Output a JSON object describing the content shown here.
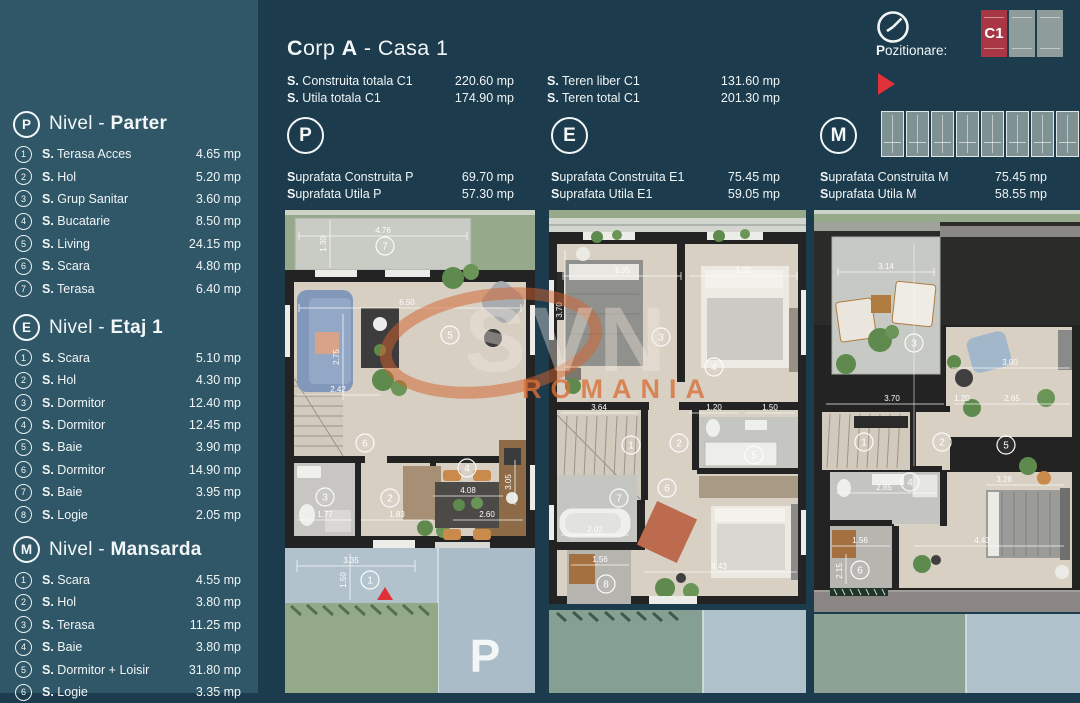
{
  "header": {
    "title_segments": [
      {
        "t": "C",
        "b": 1
      },
      {
        "t": "orp ",
        "b": 0
      },
      {
        "t": "A",
        "b": 1
      },
      {
        "t": " - Casa 1",
        "b": 0
      }
    ],
    "totals_col1": [
      {
        "label": "S. Construita totala C1",
        "value": "220.60 mp"
      },
      {
        "label": "S. Utila totala C1",
        "value": "174.90 mp"
      }
    ],
    "totals_col2": [
      {
        "label": "S. Teren liber C1",
        "value": "131.60 mp"
      },
      {
        "label": "S. Teren total C1",
        "value": "201.30 mp"
      }
    ]
  },
  "pozitionare": {
    "label": "Pozitionare:",
    "unit_tiles": [
      {
        "tag": "C1",
        "variant": "red"
      },
      {
        "tag": "",
        "variant": "grey"
      },
      {
        "tag": "",
        "variant": "grey"
      }
    ],
    "site_tiles": 8
  },
  "sidebar": {
    "sections": [
      {
        "letter": "P",
        "title_prefix": "Nivel - ",
        "title_bold": "Parter",
        "items": [
          {
            "num": "1",
            "label": "S. Terasa Acces",
            "value": "4.65 mp"
          },
          {
            "num": "2",
            "label": "S. Hol",
            "value": "5.20 mp"
          },
          {
            "num": "3",
            "label": "S. Grup Sanitar",
            "value": "3.60 mp"
          },
          {
            "num": "4",
            "label": "S. Bucatarie",
            "value": "8.50 mp"
          },
          {
            "num": "5",
            "label": "S. Living",
            "value": "24.15 mp"
          },
          {
            "num": "6",
            "label": "S. Scara",
            "value": "4.80 mp"
          },
          {
            "num": "7",
            "label": "S. Terasa",
            "value": "6.40 mp"
          }
        ]
      },
      {
        "letter": "E",
        "title_prefix": "Nivel - ",
        "title_bold": "Etaj 1",
        "items": [
          {
            "num": "1",
            "label": "S. Scara",
            "value": "5.10 mp"
          },
          {
            "num": "2",
            "label": "S. Hol",
            "value": "4.30 mp"
          },
          {
            "num": "3",
            "label": "S. Dormitor",
            "value": "12.40 mp"
          },
          {
            "num": "4",
            "label": "S. Dormitor",
            "value": "12.45 mp"
          },
          {
            "num": "5",
            "label": "S. Baie",
            "value": "3.90 mp"
          },
          {
            "num": "6",
            "label": "S. Dormitor",
            "value": "14.90 mp"
          },
          {
            "num": "7",
            "label": "S. Baie",
            "value": "3.95 mp"
          },
          {
            "num": "8",
            "label": "S. Logie",
            "value": "2.05 mp"
          }
        ]
      },
      {
        "letter": "M",
        "title_prefix": "Nivel - ",
        "title_bold": "Mansarda",
        "items": [
          {
            "num": "1",
            "label": "S. Scara",
            "value": "4.55 mp"
          },
          {
            "num": "2",
            "label": "S. Hol",
            "value": "3.80 mp"
          },
          {
            "num": "3",
            "label": "S. Terasa",
            "value": "11.25 mp"
          },
          {
            "num": "4",
            "label": "S. Baie",
            "value": "3.80 mp"
          },
          {
            "num": "5",
            "label": "S. Dormitor + Loisir",
            "value": "31.80 mp"
          },
          {
            "num": "6",
            "label": "S. Logie",
            "value": "3.35 mp"
          }
        ]
      }
    ]
  },
  "levels": [
    {
      "letter": "P",
      "rows": [
        {
          "label": "Suprafata Construita P",
          "value": "69.70 mp"
        },
        {
          "label": "Suprafata Utila P",
          "value": "57.30 mp"
        }
      ]
    },
    {
      "letter": "E",
      "rows": [
        {
          "label": "Suprafata Construita E1",
          "value": "75.45 mp"
        },
        {
          "label": "Suprafata Utila E1",
          "value": "59.05 mp"
        }
      ]
    },
    {
      "letter": "M",
      "rows": [
        {
          "label": "Suprafata Construita M",
          "value": "75.45 mp"
        },
        {
          "label": "Suprafata Utila M",
          "value": "58.55 mp"
        }
      ]
    }
  ],
  "plans": {
    "parter": {
      "rooms": [
        {
          "n": "7",
          "x": 100,
          "y": 36
        },
        {
          "n": "5",
          "x": 165,
          "y": 125
        },
        {
          "n": "6",
          "x": 80,
          "y": 233
        },
        {
          "n": "3",
          "x": 40,
          "y": 287
        },
        {
          "n": "2",
          "x": 105,
          "y": 288
        },
        {
          "n": "4",
          "x": 182,
          "y": 258
        },
        {
          "n": "1",
          "x": 85,
          "y": 370
        }
      ],
      "dims": [
        {
          "t": "4.76",
          "x": 98,
          "y": 23
        },
        {
          "t": "1.30",
          "x": 41,
          "y": 34,
          "r": -90
        },
        {
          "t": "6.50",
          "x": 122,
          "y": 95
        },
        {
          "t": "2.75",
          "x": 54,
          "y": 147,
          "r": -90
        },
        {
          "t": "2.42",
          "x": 53,
          "y": 182
        },
        {
          "t": "4.08",
          "x": 183,
          "y": 283
        },
        {
          "t": "1.77",
          "x": 40,
          "y": 307
        },
        {
          "t": "1.83",
          "x": 112,
          "y": 307
        },
        {
          "t": "2.60",
          "x": 202,
          "y": 307
        },
        {
          "t": "3.05",
          "x": 226,
          "y": 272,
          "r": -90
        },
        {
          "t": "3.35",
          "x": 66,
          "y": 353
        },
        {
          "t": "1.50",
          "x": 61,
          "y": 370,
          "r": -90
        }
      ],
      "marker": {
        "t": "P",
        "x": 200,
        "y": 462
      }
    },
    "etaj": {
      "rooms": [
        {
          "n": "3",
          "x": 112,
          "y": 127
        },
        {
          "n": "4",
          "x": 165,
          "y": 157
        },
        {
          "n": "1",
          "x": 82,
          "y": 235
        },
        {
          "n": "2",
          "x": 130,
          "y": 233
        },
        {
          "n": "5",
          "x": 205,
          "y": 245
        },
        {
          "n": "7",
          "x": 70,
          "y": 288
        },
        {
          "n": "6",
          "x": 118,
          "y": 278
        },
        {
          "n": "8",
          "x": 57,
          "y": 374
        }
      ],
      "dims": [
        {
          "t": "3.35",
          "x": 73,
          "y": 63
        },
        {
          "t": "3.00",
          "x": 194,
          "y": 63
        },
        {
          "t": "3.70",
          "x": 13,
          "y": 100,
          "r": -90
        },
        {
          "t": "3.64",
          "x": 50,
          "y": 200
        },
        {
          "t": "1.20",
          "x": 165,
          "y": 200
        },
        {
          "t": "1.50",
          "x": 221,
          "y": 200
        },
        {
          "t": "2.02",
          "x": 46,
          "y": 322
        },
        {
          "t": "4.43",
          "x": 170,
          "y": 359
        },
        {
          "t": "1.56",
          "x": 51,
          "y": 352
        }
      ]
    },
    "mansarda": {
      "rooms": [
        {
          "n": "3",
          "x": 100,
          "y": 133
        },
        {
          "n": "5",
          "x": 192,
          "y": 235
        },
        {
          "n": "1",
          "x": 50,
          "y": 232
        },
        {
          "n": "2",
          "x": 128,
          "y": 232
        },
        {
          "n": "4",
          "x": 96,
          "y": 272
        },
        {
          "n": "6",
          "x": 46,
          "y": 360
        }
      ],
      "dims": [
        {
          "t": "3.14",
          "x": 72,
          "y": 59
        },
        {
          "t": "3.00",
          "x": 196,
          "y": 155
        },
        {
          "t": "2.65",
          "x": 198,
          "y": 191
        },
        {
          "t": "3.70",
          "x": 78,
          "y": 191
        },
        {
          "t": "1.20",
          "x": 148,
          "y": 191
        },
        {
          "t": "2.85",
          "x": 70,
          "y": 280
        },
        {
          "t": "3.28",
          "x": 190,
          "y": 272
        },
        {
          "t": "4.43",
          "x": 168,
          "y": 333
        },
        {
          "t": "1.56",
          "x": 46,
          "y": 333
        },
        {
          "t": "2.15",
          "x": 28,
          "y": 361,
          "r": -90
        }
      ]
    }
  },
  "watermark": {
    "brand": "SVN",
    "country": "ROMANIA"
  },
  "colors": {
    "background": "#1C3B4D",
    "sidebar": "#2F5768",
    "text": "#F2F6F7",
    "accent_red": "#E0303A",
    "unit_tile_red": "#A93644",
    "floor": "#D7CFC2",
    "wall": "#232323",
    "lawn": "#96AA8B",
    "terrace_grey": "#C9CBC5",
    "driveway_blue": "#AFC2CB",
    "watermark_orange": "#D4622B"
  }
}
